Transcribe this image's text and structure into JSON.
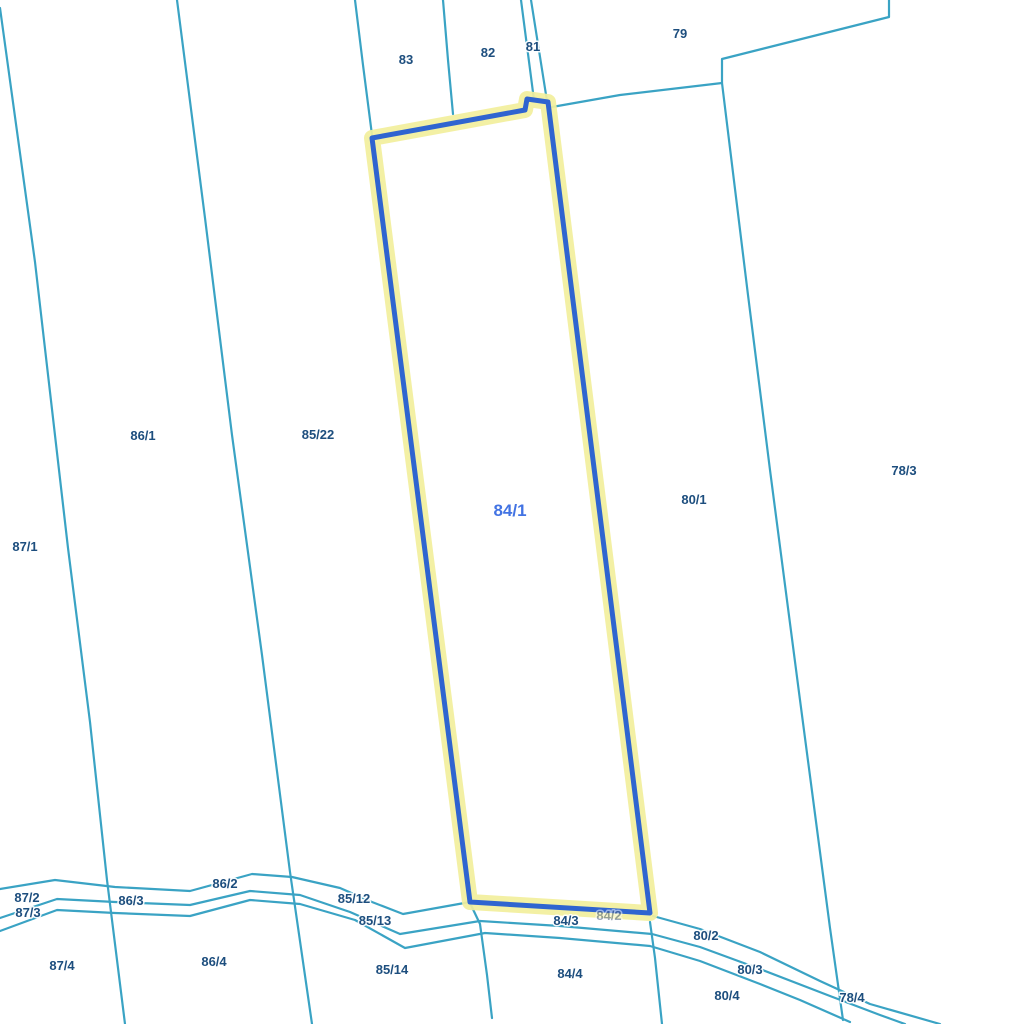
{
  "map": {
    "background": "#ffffff",
    "colors": {
      "boundary": "#3aa3c4",
      "highlight_stroke": "#2f64d0",
      "highlight_halo": "#f2ef9c",
      "label": "#1d4e7e",
      "selected_label": "#4273e3"
    },
    "selected_parcel": {
      "id": "84/1",
      "label_x": 510,
      "label_y": 516,
      "outline": "372,138 525,110 527,99 548,102 650,913 470,902"
    },
    "boundaries": [
      {
        "name": "west-line-87",
        "points": "0,8 35,262 68,548 90,722 107,880 125,1024"
      },
      {
        "name": "line-86-85",
        "points": "177,0 205,218 232,435 262,655 290,872 312,1024"
      },
      {
        "name": "line-85-83-top",
        "points": "355,0 363,65 372,135"
      },
      {
        "name": "line-83-82-top",
        "points": "443,0 448,60 453,114"
      },
      {
        "name": "line-82-81-top",
        "points": "521,0 534,100"
      },
      {
        "name": "line-81-east-top",
        "points": "531,0 547,101"
      },
      {
        "name": "line-79-south-step",
        "points": "552,107 620,95 722,83 722,59 889,17 889,0"
      },
      {
        "name": "line-80-78",
        "points": "722,83 748,295 770,470 800,700 830,928 843,1020"
      },
      {
        "name": "line-85-14-84-4",
        "points": "470,903 480,924 487,975 492,1018"
      },
      {
        "name": "line-84-4-80-4",
        "points": "650,922 655,958 662,1024"
      },
      {
        "name": "road-north-edge",
        "points": "0,889 55,880 115,887 190,891 252,874 292,877 340,888 372,902 403,914 470,902"
      },
      {
        "name": "road-middle-edge",
        "points": "0,918 57,899 115,902 190,905 250,891 300,895 350,912 400,934 480,921 560,926 652,934 700,947 760,969 830,996 880,1015 905,1024"
      },
      {
        "name": "road-south-edge",
        "points": "0,931 57,910 115,913 190,916 250,900 300,904 355,920 405,948 485,933 560,938 650,946 700,961 760,984 800,1000 850,1022"
      },
      {
        "name": "road-diagonal-80-2",
        "points": "653,916 700,929 760,952 820,981 870,1004 940,1024"
      }
    ],
    "labels": [
      {
        "text": "83",
        "x": 406,
        "y": 64
      },
      {
        "text": "82",
        "x": 488,
        "y": 57
      },
      {
        "text": "81",
        "x": 533,
        "y": 51
      },
      {
        "text": "79",
        "x": 680,
        "y": 38
      },
      {
        "text": "86/1",
        "x": 143,
        "y": 440
      },
      {
        "text": "85/22",
        "x": 318,
        "y": 439
      },
      {
        "text": "80/1",
        "x": 694,
        "y": 504
      },
      {
        "text": "78/3",
        "x": 904,
        "y": 475
      },
      {
        "text": "87/1",
        "x": 25,
        "y": 551
      },
      {
        "text": "87/2",
        "x": 27,
        "y": 902
      },
      {
        "text": "86/3",
        "x": 131,
        "y": 905
      },
      {
        "text": "87/3",
        "x": 28,
        "y": 917
      },
      {
        "text": "86/2",
        "x": 225,
        "y": 888
      },
      {
        "text": "85/12",
        "x": 354,
        "y": 903
      },
      {
        "text": "85/13",
        "x": 375,
        "y": 925
      },
      {
        "text": "84/3",
        "x": 566,
        "y": 925,
        "muted": false
      },
      {
        "text": "84/2",
        "x": 609,
        "y": 920,
        "muted": true
      },
      {
        "text": "80/2",
        "x": 706,
        "y": 940
      },
      {
        "text": "87/4",
        "x": 62,
        "y": 970
      },
      {
        "text": "86/4",
        "x": 214,
        "y": 966
      },
      {
        "text": "85/14",
        "x": 392,
        "y": 974
      },
      {
        "text": "84/4",
        "x": 570,
        "y": 978
      },
      {
        "text": "80/3",
        "x": 750,
        "y": 974
      },
      {
        "text": "80/4",
        "x": 727,
        "y": 1000
      },
      {
        "text": "78/4",
        "x": 852,
        "y": 1002
      }
    ]
  }
}
